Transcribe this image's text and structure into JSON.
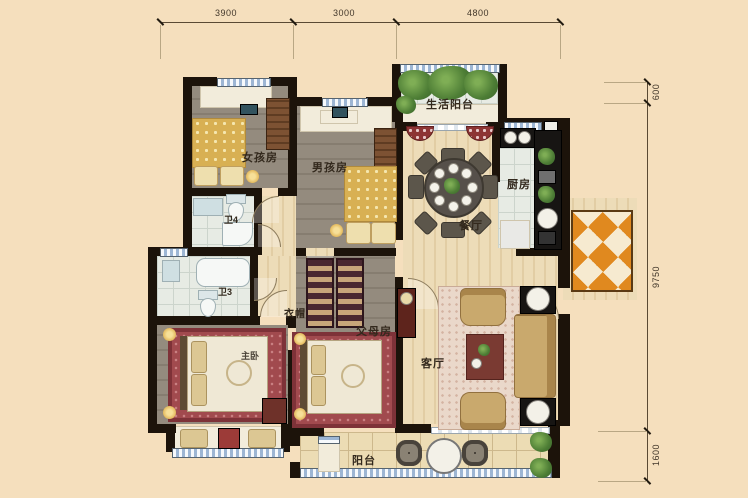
{
  "plan": {
    "type": "apartment-floor-plan",
    "dims_top": [
      {
        "label": "3900"
      },
      {
        "label": "3000"
      },
      {
        "label": "4800"
      }
    ],
    "dims_right": [
      {
        "label": "600"
      },
      {
        "label": "9750"
      },
      {
        "label": "1600"
      }
    ],
    "rooms": {
      "girls": {
        "label": "女孩房"
      },
      "boys": {
        "label": "男孩房"
      },
      "svcbalc": {
        "label": "生活阳台"
      },
      "kitchen": {
        "label": "厨房"
      },
      "dining": {
        "label": "餐厅"
      },
      "bath4": {
        "label": "卫4"
      },
      "bath3": {
        "label": "卫3"
      },
      "cloak": {
        "label": "衣帽"
      },
      "master": {
        "label": "主卧"
      },
      "parents": {
        "label": "父母房"
      },
      "living": {
        "label": "客厅"
      },
      "balcony": {
        "label": "阳台"
      }
    },
    "colors": {
      "background": "#f5dfbd",
      "wall": "#1c130a",
      "wood_floor": "#e8d5ae",
      "bedroom_floor": "#8d8477",
      "rug": "#a14a4e",
      "bed_cover": "#d8b053",
      "entry_tile_orange": "#e0891f",
      "window_blue": "#9db6d4",
      "plant_green": "#4d7d35"
    }
  }
}
